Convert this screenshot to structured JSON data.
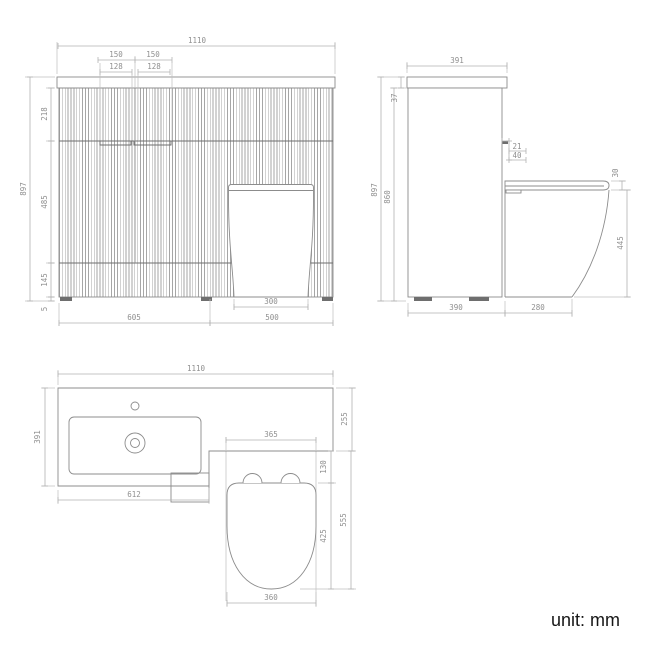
{
  "note": {
    "unit_label": "unit: mm"
  },
  "colors": {
    "background": "#ffffff",
    "object_line": "#8c8c8c",
    "object_dark_line": "#6e6e6e",
    "dimension_line": "#b2b2b2",
    "extension_line": "#bfbfbf",
    "dimension_text": "#8f8f8f",
    "flute_stripe": "#a6a6a6",
    "note_text": "#161616"
  },
  "views": {
    "front": {
      "dims": {
        "width_total": "1110",
        "handle_left_outer": "150",
        "handle_right_outer": "150",
        "handle_left_inner": "128",
        "handle_right_inner": "128",
        "height_total": "897",
        "top_section": "218",
        "mid_section": "485",
        "lower_section": "145",
        "plinth": "5",
        "toilet_base_width": "300",
        "vanity_width": "605",
        "toilet_unit_width": "500"
      }
    },
    "side": {
      "dims": {
        "depth_top": "391",
        "counter_thickness": "37",
        "height_total": "897",
        "body_height": "860",
        "flush_offset": "21",
        "flush_height": "40",
        "seat_thickness": "30",
        "seat_height": "445",
        "cabinet_depth": "390",
        "pan_projection": "280"
      }
    },
    "plan": {
      "dims": {
        "width_total": "1110",
        "basin_depth": "391",
        "counter_depth": "255",
        "basin_section_width": "612",
        "toilet_width": "365",
        "cistern_gap": "130",
        "seat_length": "425",
        "toilet_depth": "555",
        "seat_width": "360"
      }
    }
  }
}
